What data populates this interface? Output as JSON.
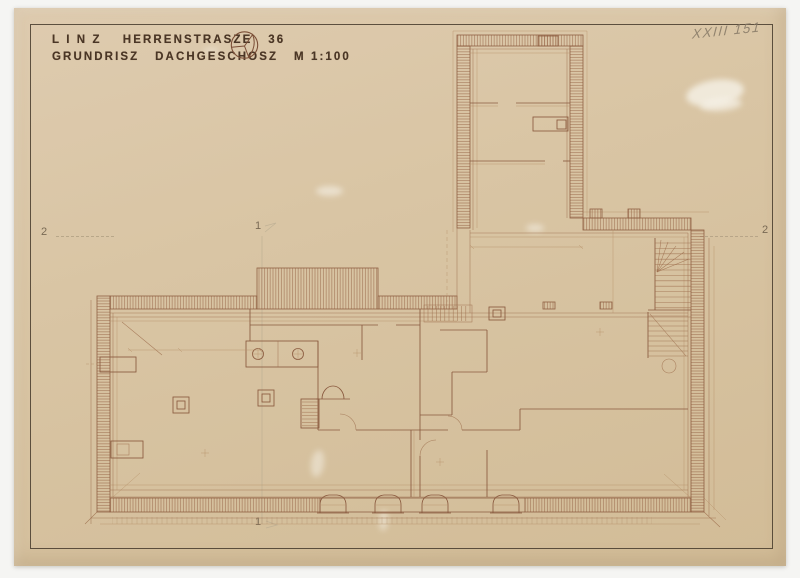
{
  "title_block": {
    "line1": "L I N Z    HERRENSTRASZE   36",
    "line2": "GRUNDRISZ   DACHGESCHOSZ   M 1:100"
  },
  "annotations": {
    "archive_number": "XXIII 151",
    "axis_marker_left": "2",
    "axis_marker_right": "2",
    "section_marker_top": "1",
    "section_marker_bottom": "1"
  },
  "drawing": {
    "building": "Linz Herrenstrasze 36",
    "sheet": "Grundrisz Dachgeschosz",
    "scale": "M 1:100"
  },
  "colors": {
    "background": "#f5f5f3",
    "paper": "#d9c5a4",
    "ink": "#94644a",
    "ink_dark": "#43382b",
    "pencil": "#8b7d6a"
  }
}
